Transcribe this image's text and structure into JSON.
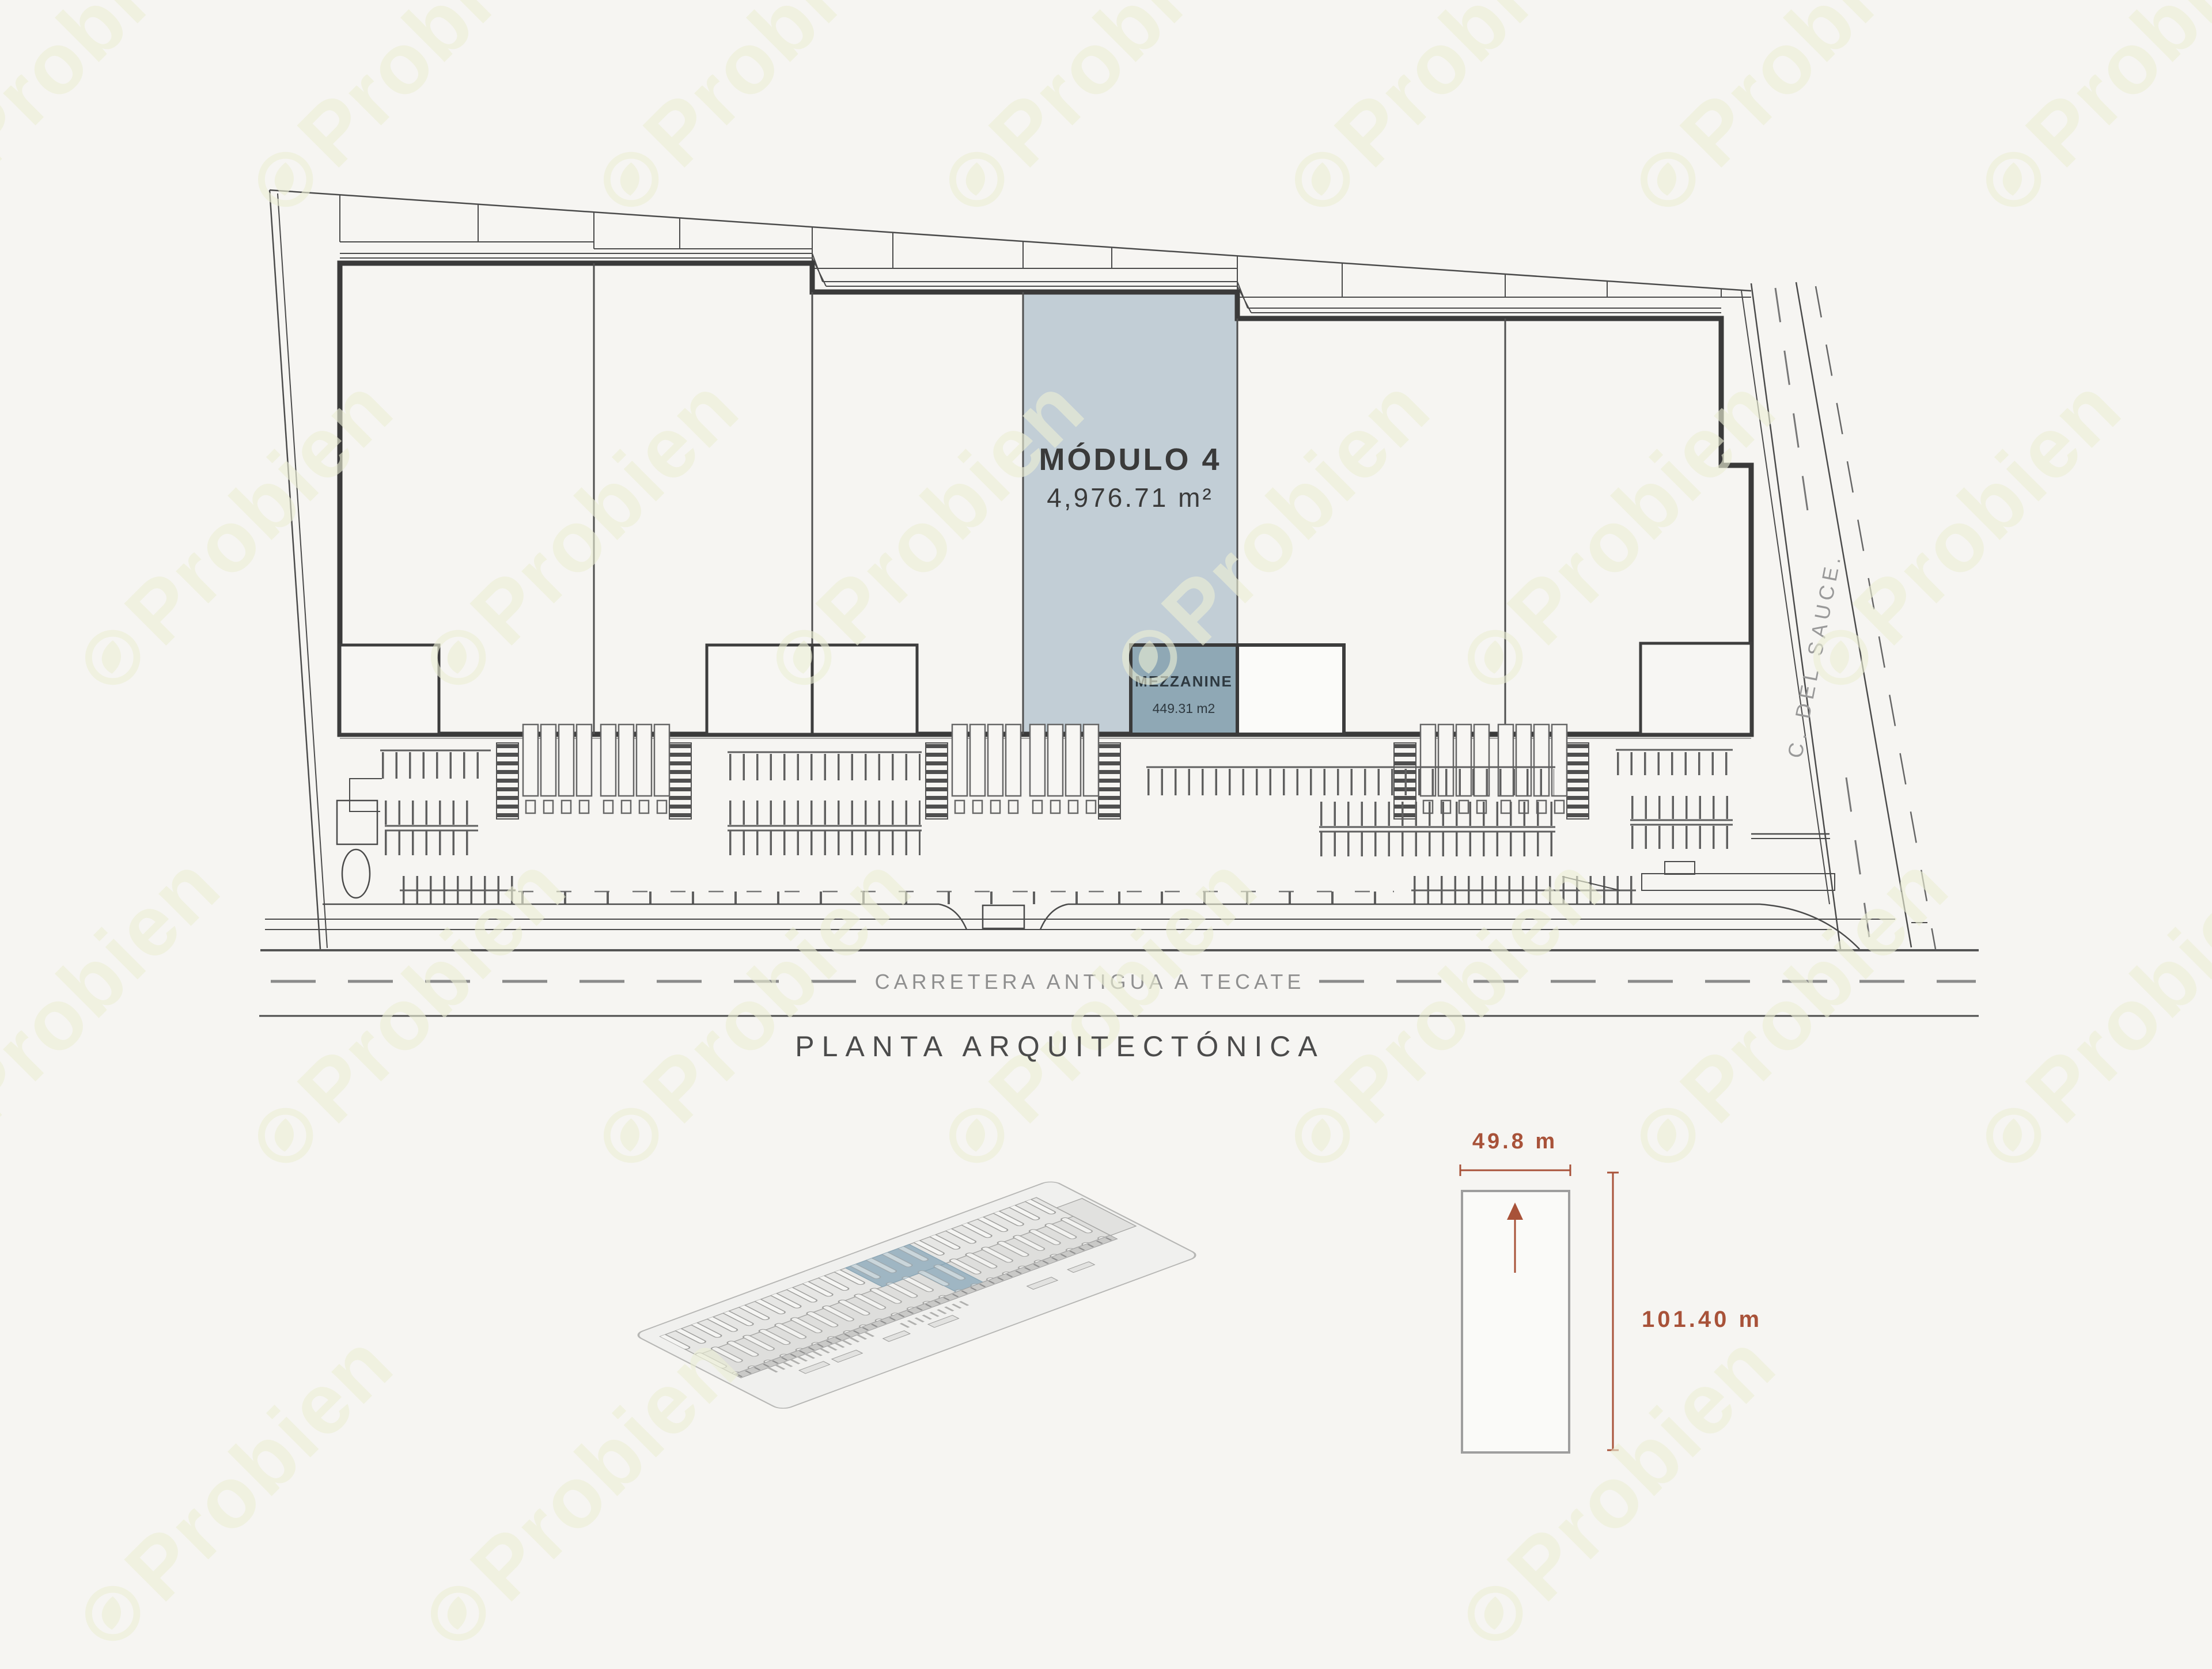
{
  "page": {
    "background": "#f6f5f2"
  },
  "watermark": {
    "text": "Probien",
    "color": "#ecefd6"
  },
  "plan": {
    "title": "PLANTA ARQUITECTÓNICA",
    "module4": {
      "label": "MÓDULO 4",
      "area": "4,976.71 m²",
      "fill": "#c2ced6"
    },
    "mezzanine": {
      "label": "MEZZANINE",
      "area": "449.31 m2",
      "fill": "#8fa8b5"
    },
    "street_right": "C. DEL SAUCE.",
    "road_bottom": "CARRETERA ANTIGUA A TECATE"
  },
  "dimension_diagram": {
    "width_label": "49.8 m",
    "height_label": "101.40 m",
    "accent_color": "#a85239"
  },
  "colors": {
    "line": "#4a4a4a",
    "module_fill": "#c2ced6",
    "mezzanine_fill": "#8fa8b5"
  }
}
